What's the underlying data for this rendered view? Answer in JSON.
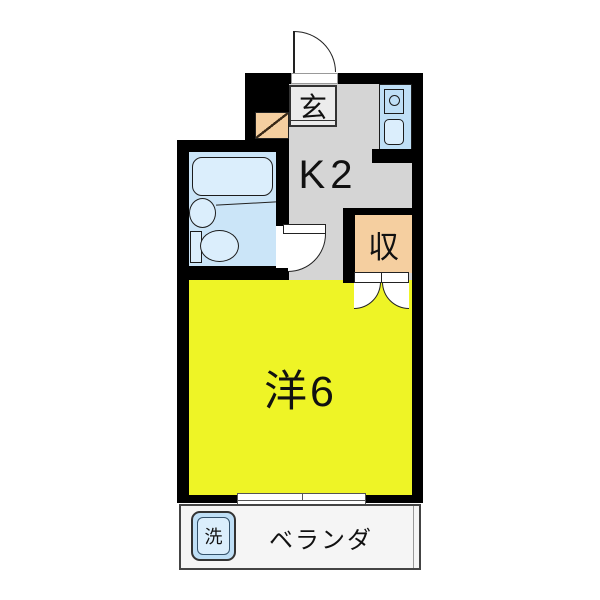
{
  "plan": {
    "title": "1K apartment floor plan",
    "rooms": {
      "entrance": {
        "label": "玄"
      },
      "kitchen": {
        "label": "K2"
      },
      "closet": {
        "label": "収"
      },
      "western_room": {
        "label": "洋6"
      },
      "veranda": {
        "label": "ベランダ"
      },
      "laundry": {
        "label": "洗"
      }
    },
    "fixtures": [
      "bathtub",
      "washbasin",
      "toilet",
      "toilet-tank",
      "stove",
      "kitchen-sink",
      "washing-machine",
      "shoe-cabinet",
      "entrance-door",
      "bathroom-door",
      "closet-double-doors",
      "sliding-window"
    ]
  },
  "colors": {
    "wall_black": "#000000",
    "room_yellow": "#eef426",
    "kitchen_gray": "#d5d5d5",
    "entrance_gray": "#ececec",
    "closet_peach": "#f5cfa0",
    "bath_blue_bg": "#cbe5f8",
    "fixture_blue": "#dbeefc",
    "unit_blue": "#bfdff6",
    "veranda_bg": "#f5f5f5"
  }
}
